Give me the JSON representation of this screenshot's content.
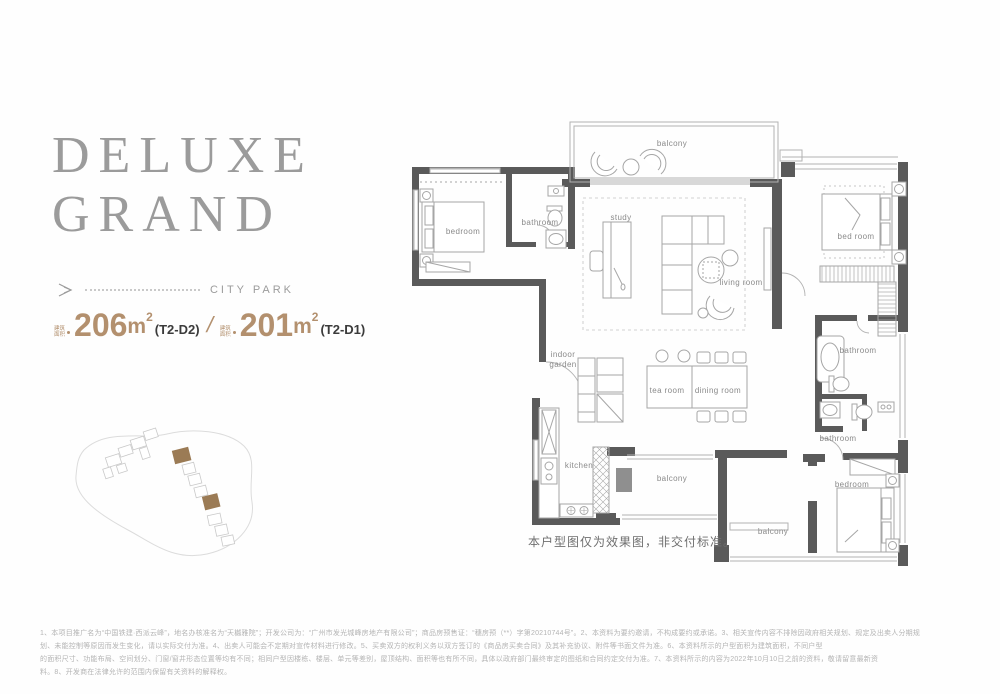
{
  "left_panel": {
    "title_line1": "DELUXE",
    "title_line2": "GRAND",
    "tagline": "CITY PARK",
    "accent_color": "#b3906e",
    "title_color": "#9b9b9b",
    "area_icon_text_top": "建筑",
    "area_icon_text_bottom": "面积",
    "areas": [
      {
        "value": "206",
        "unit": "m",
        "sup": "2",
        "code": "(T2-D2)"
      },
      {
        "value": "201",
        "unit": "m",
        "sup": "2",
        "code": "(T2-D1)"
      }
    ],
    "area_separator": "/"
  },
  "floorplan": {
    "wall_color": "#5a5a5a",
    "furniture_color": "#a6a6a6",
    "label_color": "#8a8a8a",
    "rooms": [
      {
        "label": "balcony"
      },
      {
        "label": "bedroom"
      },
      {
        "label": "bathroom"
      },
      {
        "label": "study"
      },
      {
        "label": "living room"
      },
      {
        "label": "bed room"
      },
      {
        "label": "bathroom"
      },
      {
        "label": "bathroom"
      },
      {
        "label": "indoor"
      },
      {
        "label": "garden"
      },
      {
        "label": "tea room"
      },
      {
        "label": "dining room"
      },
      {
        "label": "kitchen"
      },
      {
        "label": "balcony"
      },
      {
        "label": "bedroom"
      },
      {
        "label": "balcony"
      }
    ],
    "disclaimer": "本户型图仅为效果图，非交付标准。"
  },
  "siteplan": {
    "highlight_color": "#9b7b55"
  },
  "footnotes": {
    "lines": [
      "1、本项目推广名为“中国铁建·西派云峰”，地名办核准名为“天樾雅院”；开发公司为：“广州市发光城峰房地产有限公司”；商品房预售证：“穗房预（**）字第20210744号”。2、本资料为要约邀请，不构成要约或承诺。3、相关宣传内容不排除因政府相关规划、规定及出卖人分期规",
      "划、未能控制等原因而发生变化，请以实际交付为准。4、出卖人可能会不定期对宣传材料进行修改。5、买卖双方的权利义务以双方签订的《商品房买卖合同》及其补充协议、附件等书面文件为准。6、本资料所示的户型面积为建筑面积，不同户型",
      "的面积尺寸、功能布局、空间划分、门窗/窗井形态位置等均有不同；相同户型因楼栋、楼层、单元等差别，屋顶结构、面积等也有所不同，具体以政府部门最终审定的图纸和合同约定交付为准。7、本资料所示的内容为2022年10月10日之前的资料，敬请留意最新资",
      "料。8、开发商在法律允许的范围内保留有关资料的解释权。"
    ]
  }
}
